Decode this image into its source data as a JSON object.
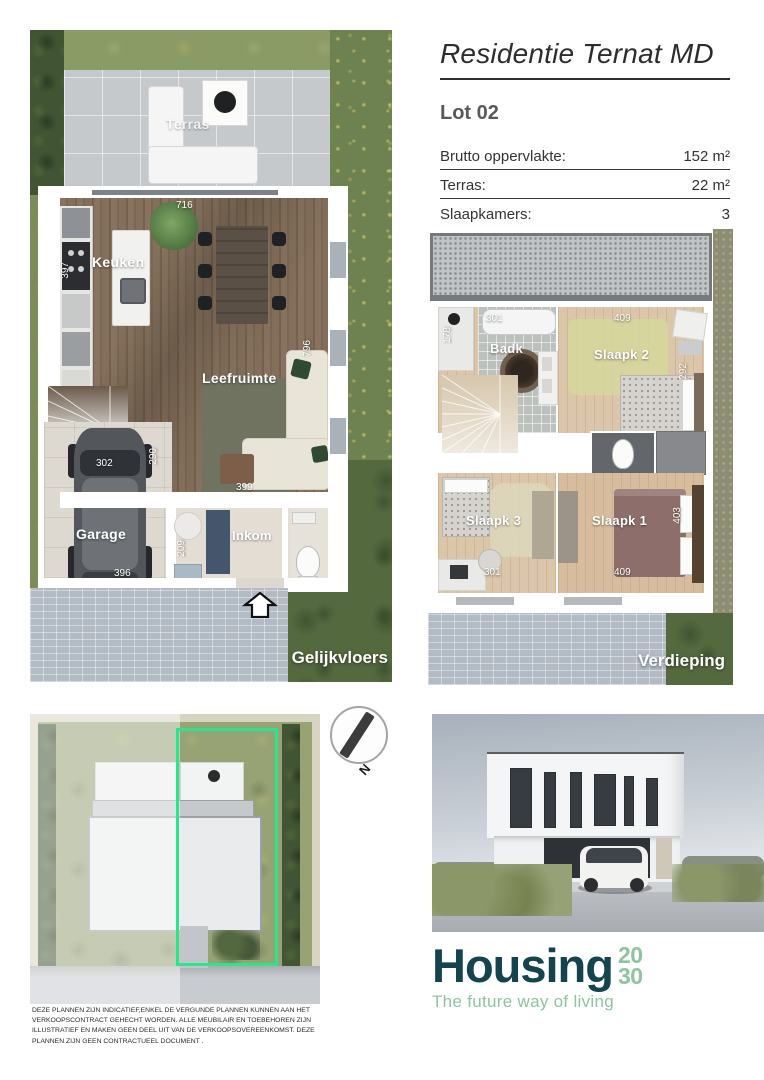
{
  "header": {
    "title": "Residentie Ternat MD",
    "lot_label": "Lot 02",
    "specs": [
      {
        "label": "Brutto oppervlakte:",
        "value": "152 m²"
      },
      {
        "label": "Terras:",
        "value": "22 m²"
      },
      {
        "label": "Slaapkamers:",
        "value": "3"
      }
    ]
  },
  "ground_floor": {
    "caption": "Gelijkvloers",
    "rooms": {
      "terras": "Terras",
      "keuken": "Keuken",
      "leefruimte": "Leefruimte",
      "garage": "Garage",
      "inkom": "Inkom"
    },
    "dims": {
      "living_width": "716",
      "kitchen_depth": "397",
      "living_depth": "796",
      "garage_width": "302",
      "garage_depth": "290",
      "garage_bottom": "396",
      "entry_depth": "209",
      "hall_width": "399"
    }
  },
  "upper_floor": {
    "caption": "Verdieping",
    "rooms": {
      "badk": "Badk",
      "slaapk2": "Slaapk 2",
      "slaapk3": "Slaapk 3",
      "slaapk1": "Slaapk 1"
    },
    "dims": {
      "badk_width": "301",
      "badk_depth": "178",
      "slaapk2_width": "409",
      "slaapk2_depth": "292",
      "slaapk3_width": "301",
      "slaapk1_width": "409",
      "slaapk1_depth": "403"
    }
  },
  "site_plan": {
    "north": "N"
  },
  "branding": {
    "name": "Housing",
    "year_top": "20",
    "year_bottom": "30",
    "tagline": "The future way of living",
    "brand_color": "#14444e",
    "accent_color": "#8fc4a0",
    "lot_outline_color": "#2de38c"
  },
  "disclaimer": "DEZE PLANNEN ZIJN INDICATIEF,ENKEL DE VERGUNDE PLANNEN KUNNEN AAN HET VERKOOPSCONTRACT GEHECHT WORDEN. ALLE MEUBILAIR EN TOEBEHOREN ZIJN ILLUSTRATIEF EN MAKEN GEEN DEEL UIT VAN DE VERKOOPSOVEREENKOMST. DEZE PLANNEN ZIJN GEEN CONTRACTUEEL DOCUMENT ."
}
